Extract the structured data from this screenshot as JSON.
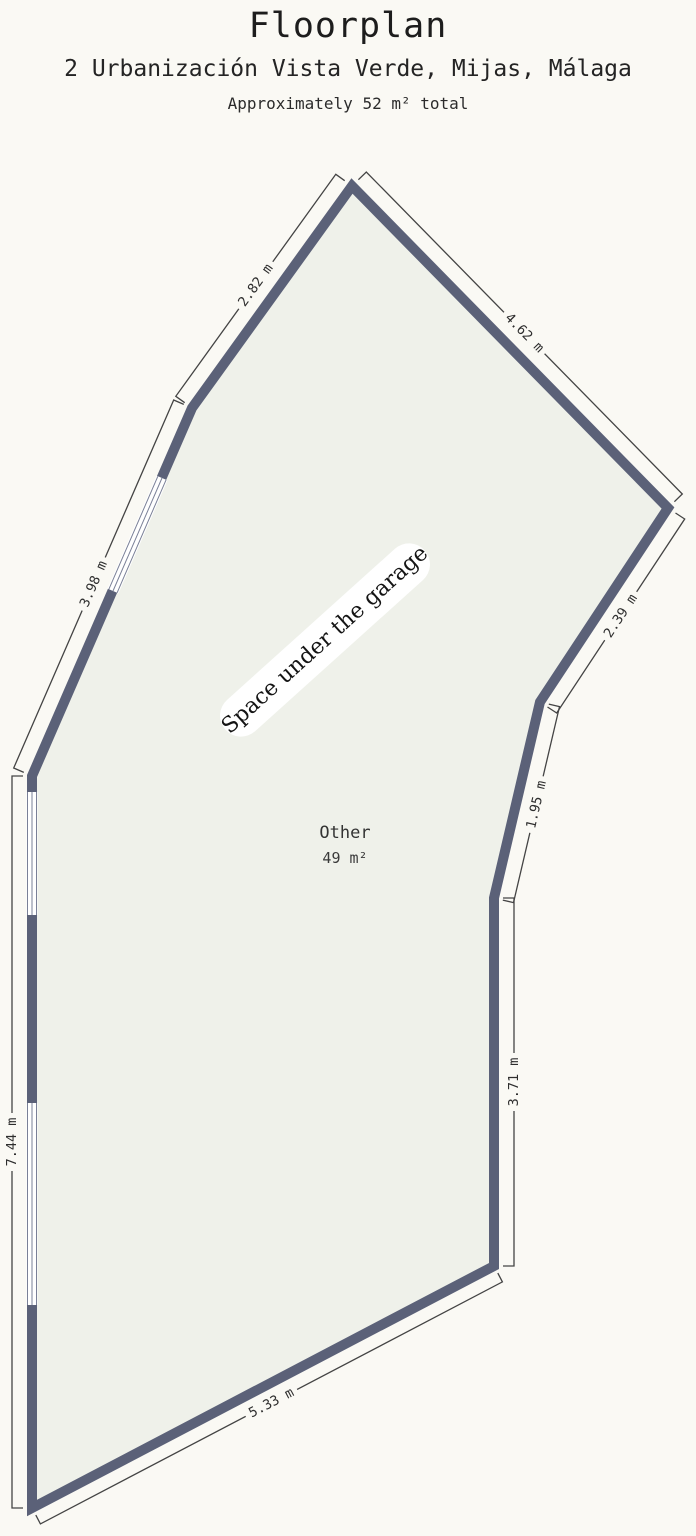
{
  "header": {
    "title": "Floorplan",
    "address": "2 Urbanización Vista Verde, Mijas, Málaga",
    "area_note": "Approximately 52 m² total"
  },
  "floorplan": {
    "annotation": "Space under the garage",
    "room": {
      "name": "Other",
      "area": "49 m²"
    },
    "walls": [
      {
        "id": "upper-left",
        "label": "2.82 m"
      },
      {
        "id": "upper-right",
        "label": "4.62 m"
      },
      {
        "id": "left-diagonal",
        "label": "3.98 m"
      },
      {
        "id": "left",
        "label": "7.44 m"
      },
      {
        "id": "bottom",
        "label": "5.33 m"
      },
      {
        "id": "right-lower",
        "label": "3.71 m"
      },
      {
        "id": "right-mid-diagonal",
        "label": "1.95 m"
      },
      {
        "id": "right-upper-diagonal",
        "label": "2.39 m"
      }
    ],
    "colors": {
      "wall": "#5b6178",
      "floor": "#eff1ea",
      "background": "#faf9f4",
      "dimension_line": "#444444",
      "window_frame": "#7a8097"
    }
  }
}
